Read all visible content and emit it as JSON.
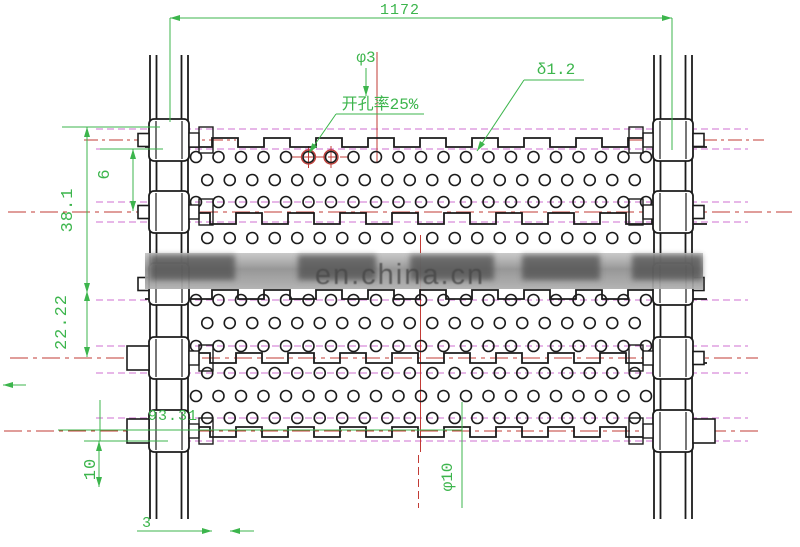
{
  "drawing": {
    "watermark": "en.china.cn",
    "dimensions": {
      "total_width": "1172",
      "hole_diameter": "φ3",
      "open_area": "开孔率25%",
      "plate_thickness": "δ1.2",
      "pitch": "38.1",
      "edge_offset": "6",
      "row_spacing": "22.22",
      "side_margin": "93.31",
      "tab_height": "10",
      "bar_thickness": "3",
      "roller_diameter": "φ10"
    },
    "colors": {
      "dimension_green": "#3cb54c",
      "centerline_red": "#c23b35",
      "hole_axis_magenta": "#cf6fd0",
      "line_black": "#1c1c1c",
      "watermark_gray": "#8f8f8f"
    }
  }
}
